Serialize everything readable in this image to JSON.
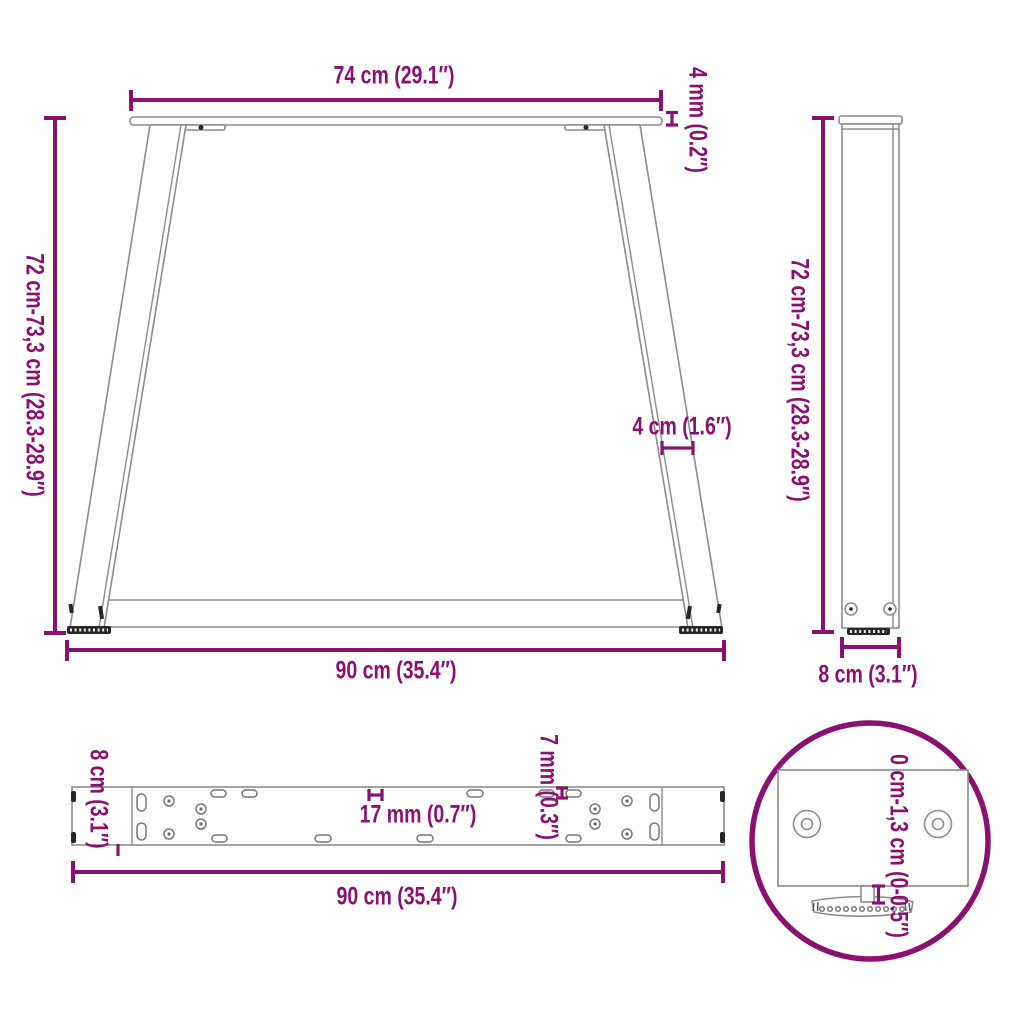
{
  "colors": {
    "dimension": "#8A1170",
    "outline": "#8C8C8C",
    "dark": "#262626"
  },
  "views": {
    "front": {
      "top_width": "74 cm (29.1″)",
      "plate_thickness": "4 mm (0.2″)",
      "height_range": "72 cm-73,3 cm (28.3-28.9″)",
      "leg_width": "4 cm (1.6″)",
      "bottom_width": "90 cm (35.4″)"
    },
    "side": {
      "height_range": "72 cm-73,3 cm (28.3-28.9″)",
      "depth": "8 cm (3.1″)"
    },
    "top": {
      "depth": "8 cm (3.1″)",
      "slot_width": "17 mm (0.7″)",
      "hole_width": "7 mm (0.3″)",
      "length": "90 cm (35.4″)"
    },
    "detail": {
      "adjustment_range": "0 cm-1,3 cm (0-0.5″)"
    }
  }
}
